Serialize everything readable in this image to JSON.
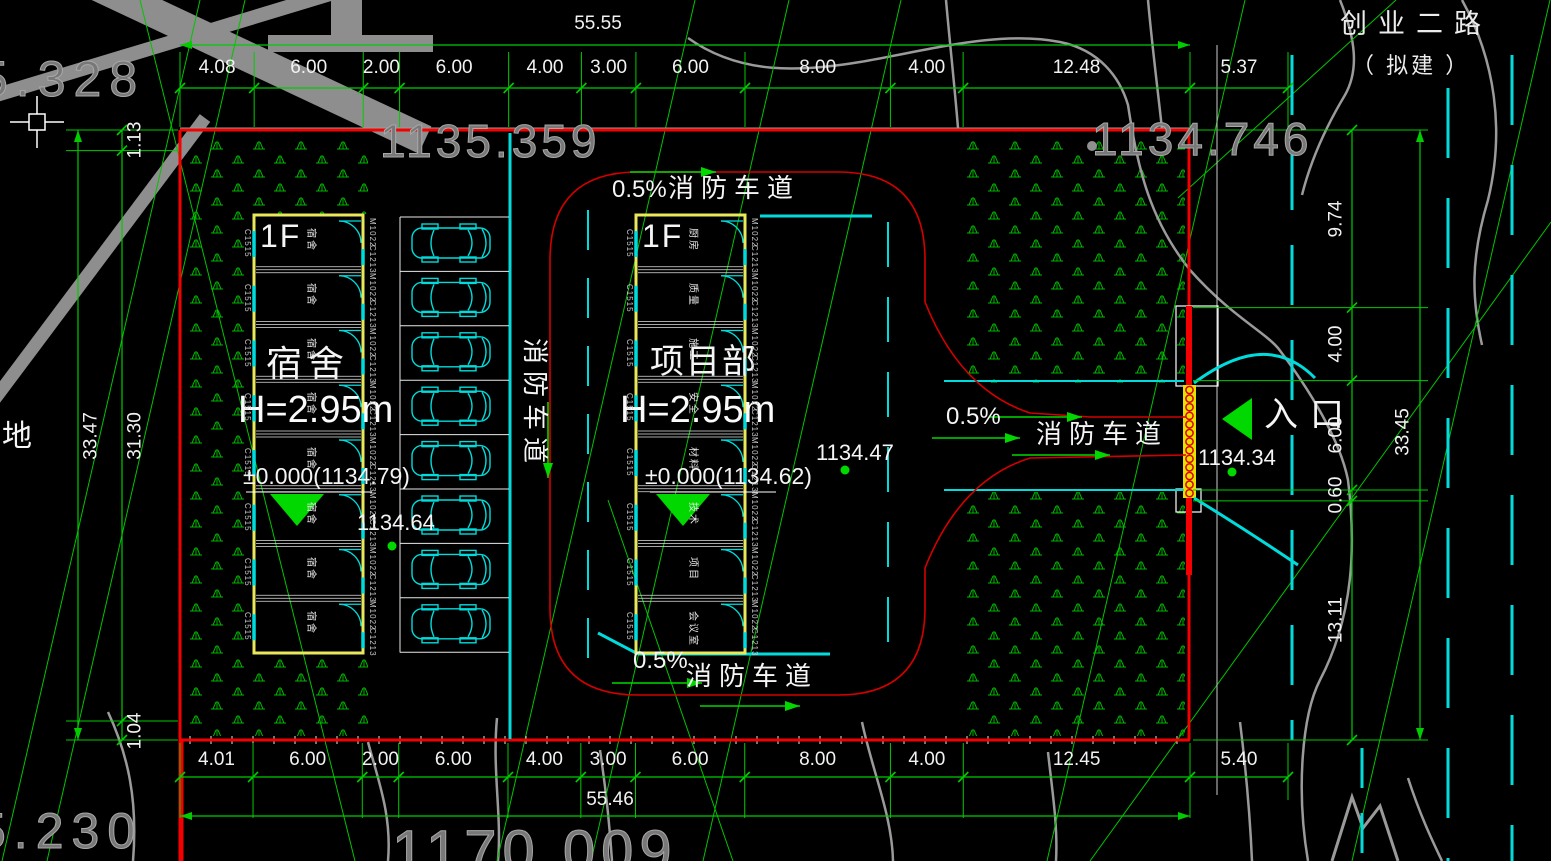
{
  "drawing": {
    "road": {
      "name": "创业二路",
      "status": "（ 拟建 ）"
    },
    "site_label": "地",
    "fire_lane_label": "消防车道",
    "slope_label": "0.5%",
    "entrance": {
      "label": "入口",
      "elev_outside": "1134.34",
      "elev_road": "1134.47"
    },
    "contour_labels": {
      "top_left": "5.328",
      "top_mid": "1135.359",
      "top_right": "1134.746",
      "bottom_left": "5.230",
      "bottom_mid": "1170.009"
    }
  },
  "buildings": {
    "left": {
      "floor": "1F",
      "name": "宿舍",
      "height": "H=2.95m",
      "level": "±0.000(1134.79)",
      "spot_elev": "1134.64",
      "rooms": [
        "宿舍",
        "宿舍",
        "宿舍",
        "宿舍",
        "宿舍",
        "宿舍",
        "宿舍",
        "宿舍"
      ],
      "codes": {
        "window_left": "C1515",
        "door_right": "M1022",
        "window_right": "C1213"
      }
    },
    "right": {
      "floor": "1F",
      "name": "项目部",
      "height": "H=2.95m",
      "level": "±0.000(1134.62)",
      "rooms": [
        "厨房",
        "质量",
        "施工",
        "安全",
        "材料",
        "技术",
        "项目",
        "会议室"
      ],
      "codes": {
        "window_left": "C1515",
        "door_right": "M1022",
        "window_right": "C1213"
      }
    }
  },
  "dimensions": {
    "top": {
      "segments": [
        "4.08",
        "6.00",
        "2.00",
        "6.00",
        "4.00",
        "3.00",
        "6.00",
        "8.00",
        "4.00",
        "12.48"
      ],
      "total": "55.55",
      "extra": "5.37"
    },
    "bottom": {
      "segments": [
        "4.01",
        "6.00",
        "2.00",
        "6.00",
        "4.00",
        "3.00",
        "6.00",
        "8.00",
        "4.00",
        "12.45"
      ],
      "total": "55.46",
      "extra": "5.40"
    },
    "left": {
      "segments": [
        "1.13",
        "31.30",
        "1.04"
      ],
      "total": "33.47"
    },
    "right": {
      "segments": [
        "9.74",
        "4.00",
        "6.00",
        "0.60",
        "13.11"
      ],
      "total": "33.45"
    }
  },
  "colors": {
    "boundary": "#f40000",
    "fire_lane": "#d40000",
    "dimension": "#00cc00",
    "survey": "#00c400",
    "grass": "#00b400",
    "road_edge": "#00dcdc",
    "building": "#e8e85a",
    "contour": "#9a9a9a",
    "text": "#f5f5f5",
    "marker": "#00d800",
    "gate": "#e8e000"
  }
}
